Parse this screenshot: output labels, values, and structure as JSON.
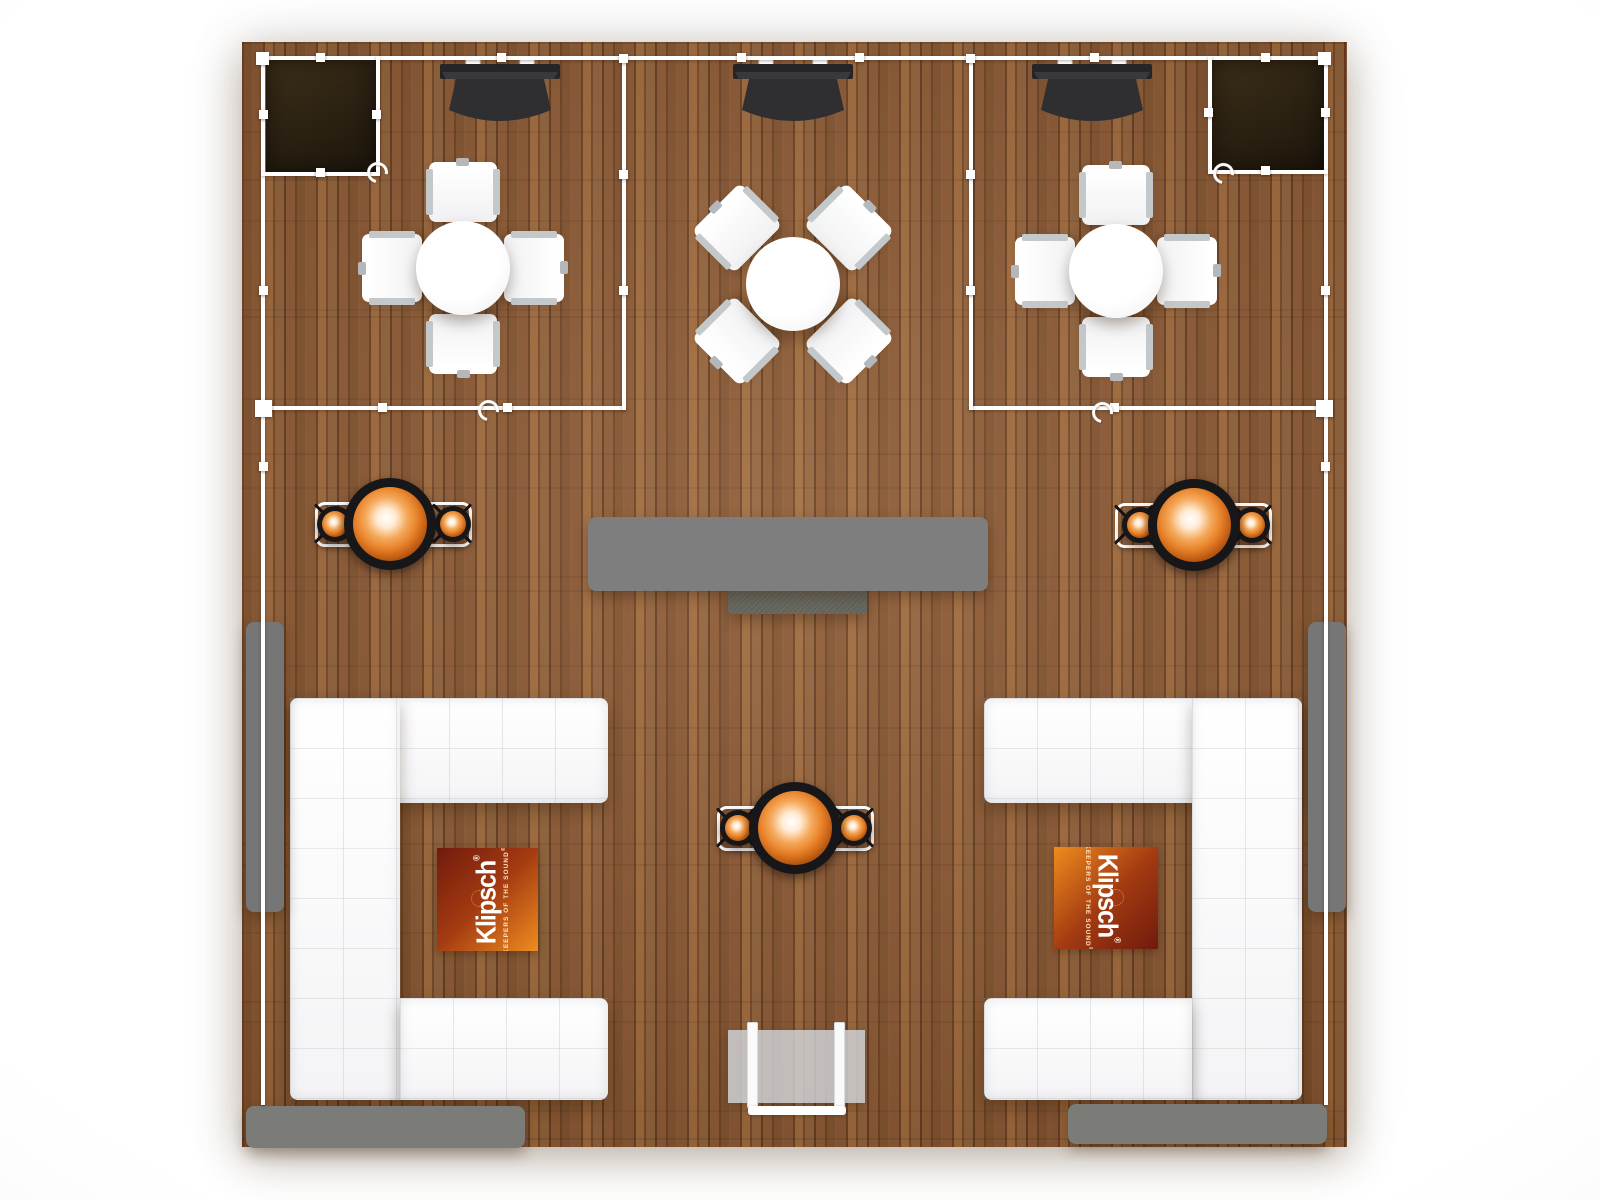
{
  "scene": {
    "title": "Klipsch booth floor plan — top-down view",
    "floor_material": "wood plank flooring"
  },
  "rugs": {
    "brand": "Klipsch",
    "brand_reg": "®",
    "tagline": "KEEPERS OF THE SOUND",
    "tagline_reg": "®",
    "count": 2
  },
  "colors": {
    "rug-orange": "#ef8c1f",
    "rug-maroon": "#701b0d",
    "wood-base": "#8a5630",
    "wood-dark": "#6e4121",
    "wood-light": "#a06838",
    "boundary-white": "#ffffff",
    "desk-gray": "#7e7e7e",
    "bench-gray": "#767676",
    "mat-gray": "#7b7b78",
    "speaker-ring-black": "#17171a",
    "cone-orange": "#e8832a",
    "horn-dark": "#2f2f32",
    "closet-brown": "#2e2414",
    "sofa-white": "#fbfbfc"
  },
  "icons": {
    "rotate_handle": "rotate-handle-icon",
    "selection_handle": "selection-handle"
  }
}
